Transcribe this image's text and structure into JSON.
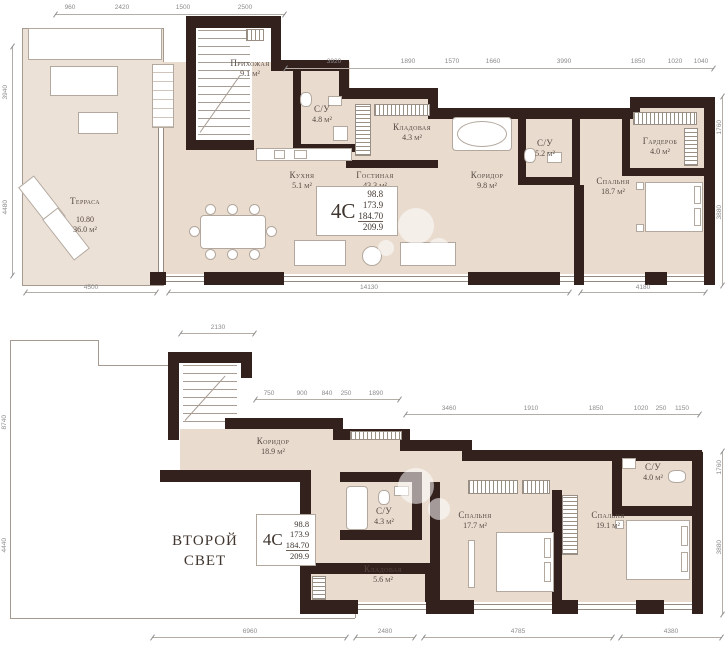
{
  "unit": {
    "type_label": "4С",
    "area_values": [
      "98.8",
      "173.9",
      "184.70",
      "209.9"
    ]
  },
  "floor1": {
    "rooms": [
      {
        "name": "Прихожая",
        "area": "9.1 м²"
      },
      {
        "name": "С/У",
        "area": "4.8 м²"
      },
      {
        "name": "Кладовая",
        "area": "4.3 м²"
      },
      {
        "name": "Кухня",
        "area": "5.1 м²"
      },
      {
        "name": "Гостиная",
        "area": "43.3 м²"
      },
      {
        "name": "Коридор",
        "area": "9.8 м²"
      },
      {
        "name": "С/У",
        "area": "5.2 м²"
      },
      {
        "name": "Гардероб",
        "area": "4.0 м²"
      },
      {
        "name": "Спальня",
        "area": "18.7 м²"
      },
      {
        "name": "Терраса",
        "coeff": "10.80",
        "area": "36.0 м²"
      }
    ],
    "dims_top_left": [
      "960",
      "2420",
      "1500",
      "2500"
    ],
    "dims_top_right": [
      "3920",
      "1890",
      "1570",
      "1660",
      "3990",
      "1850",
      "1020",
      "1040"
    ],
    "dims_bottom": [
      "4500",
      "14130",
      "4180"
    ],
    "dims_left": [
      "3940",
      "4480"
    ],
    "dims_right": [
      "1760",
      "3880"
    ]
  },
  "floor2": {
    "void_label": "ВТОРОЙ СВЕТ",
    "rooms": [
      {
        "name": "Коридор",
        "area": "18.9 м²"
      },
      {
        "name": "С/У",
        "area": "4.3 м²"
      },
      {
        "name": "Кладовая",
        "area": "5.6 м²"
      },
      {
        "name": "Спальня",
        "area": "17.7 м²"
      },
      {
        "name": "Спальня",
        "area": "19.1 м²"
      },
      {
        "name": "С/У",
        "area": "4.0 м²"
      }
    ],
    "dims_top": [
      "2130"
    ],
    "dims_mid_left": [
      "750",
      "900",
      "840",
      "250",
      "1890"
    ],
    "dims_mid_right": [
      "3460",
      "1910",
      "1850",
      "1020",
      "250",
      "1150"
    ],
    "dims_bottom": [
      "6960",
      "2480",
      "4785",
      "4380"
    ],
    "dims_left": [
      "8740",
      "4440"
    ],
    "dims_right": [
      "1760",
      "3880"
    ]
  }
}
